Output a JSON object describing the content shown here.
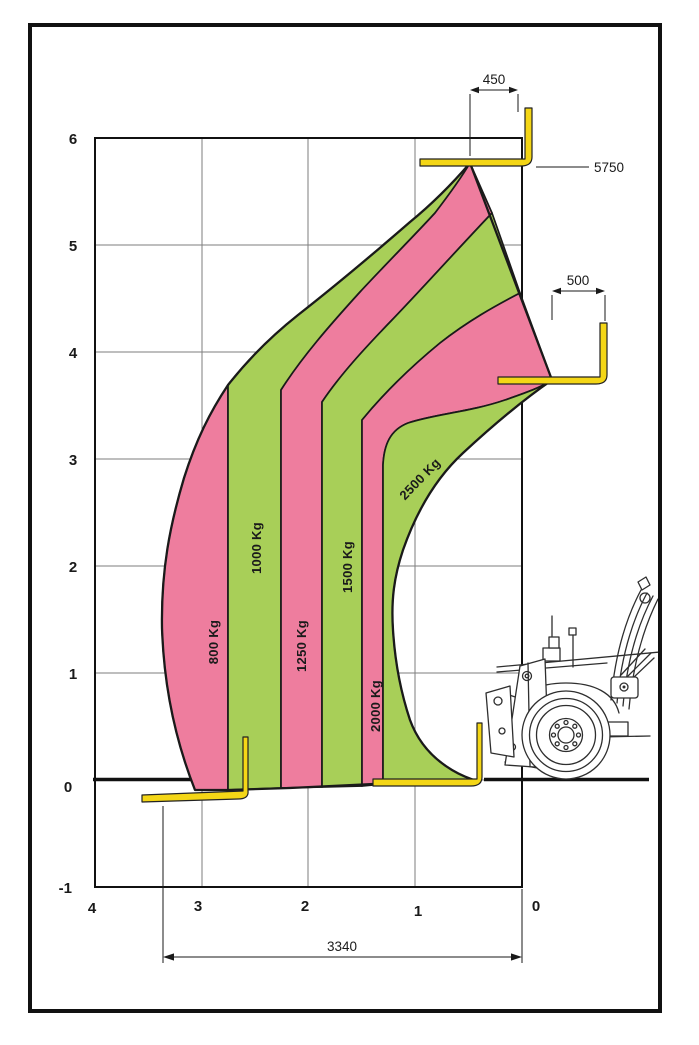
{
  "chart_data": {
    "type": "area",
    "title": "Telehandler load capacity chart",
    "x_axis": {
      "ticks": [
        "4",
        "3",
        "2",
        "1",
        "0"
      ],
      "range_m": [
        4,
        0
      ],
      "grid": true
    },
    "y_axis": {
      "ticks": [
        "6",
        "5",
        "4",
        "3",
        "2",
        "1",
        "0",
        "-1"
      ],
      "range_m": [
        -1,
        6
      ],
      "grid": true
    },
    "zones": [
      {
        "label": "800 Kg",
        "capacity_kg": 800,
        "color": "#ee7d9e"
      },
      {
        "label": "1000 Kg",
        "capacity_kg": 1000,
        "color": "#a8cf58"
      },
      {
        "label": "1250 Kg",
        "capacity_kg": 1250,
        "color": "#ee7d9e"
      },
      {
        "label": "1500 Kg",
        "capacity_kg": 1500,
        "color": "#a8cf58"
      },
      {
        "label": "2000 Kg",
        "capacity_kg": 2000,
        "color": "#ee7d9e"
      },
      {
        "label": "2500 Kg",
        "capacity_kg": 2500,
        "color": "#a8cf58"
      }
    ],
    "annotations": {
      "top_load_center_mm": "450",
      "mid_load_center_mm": "500",
      "max_lift_height_mm": "5750",
      "max_reach_mm": "3340"
    },
    "envelope": {
      "max_height_m": 5.75,
      "max_reach_m": 3.34,
      "peak_at": {
        "reach_m": 0.48,
        "height_m": 5.75
      },
      "mid_vertex_at": {
        "reach_m": -0.28,
        "height_m": 3.75
      },
      "ground_level_m": 0
    }
  },
  "colors": {
    "zone_pink": "#ee7d9e",
    "zone_green": "#a8cf58",
    "fork_yellow": "#f4d616",
    "outline": "#1a1a1a",
    "grid_line": "#7d7d7d",
    "machine_line": "#2e2e2e"
  }
}
